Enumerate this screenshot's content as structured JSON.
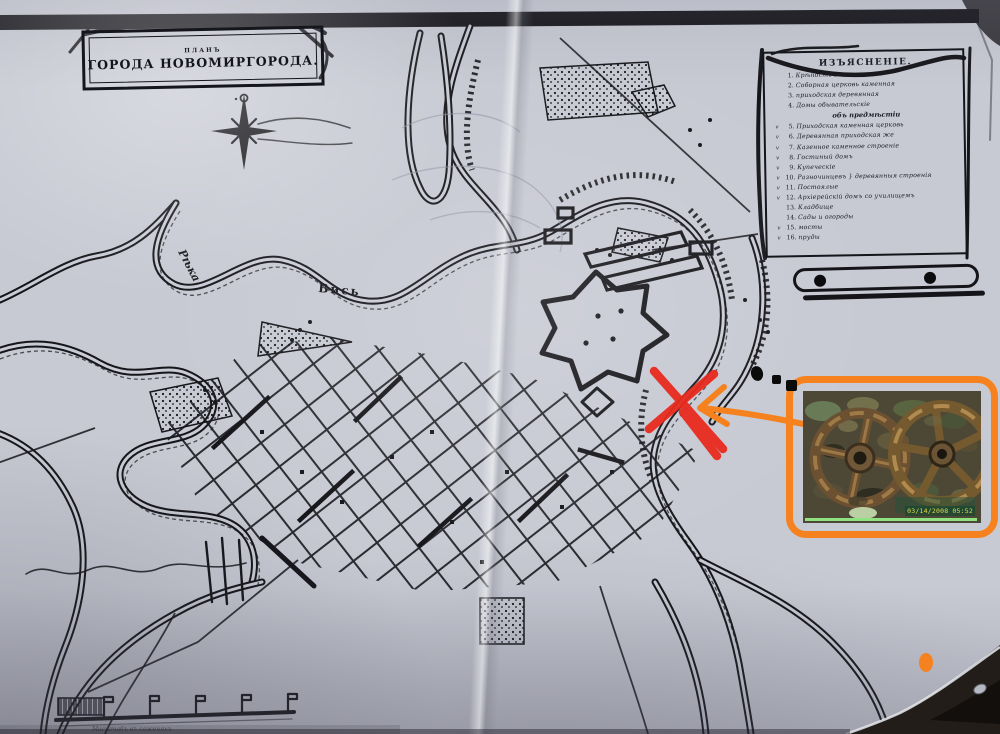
{
  "map": {
    "title": {
      "small": "ПЛАНЪ",
      "main": "ГОРОДА НОВОМИРГОРОДА."
    },
    "labels": {
      "river_word": "Рѣка",
      "river_name": "Вись"
    },
    "scale": {
      "caption": "Масштабъ въ саженяхъ"
    }
  },
  "legend": {
    "header": "ИЗЪЯСНЕНІЕ.",
    "subheader": "объ предмѣстіи",
    "items": [
      {
        "mark": "",
        "n": "1.",
        "text": "Крѣпость земляная"
      },
      {
        "mark": "",
        "n": "2.",
        "text": "Соборная церковь каменная"
      },
      {
        "mark": "",
        "n": "3.",
        "text": "приходская деревянная"
      },
      {
        "mark": "",
        "n": "4.",
        "text": "Домы обывательскіе"
      },
      {
        "mark": "v",
        "n": "5.",
        "text": "Приходская каменная церковь"
      },
      {
        "mark": "v",
        "n": "6.",
        "text": "Деревянная приходская же"
      },
      {
        "mark": "v",
        "n": "7.",
        "text": "Казенное каменное строеніе"
      },
      {
        "mark": "v",
        "n": "8.",
        "text": "Гостиный домъ"
      },
      {
        "mark": "v",
        "n": "9.",
        "text": "Купеческіе"
      },
      {
        "mark": "v",
        "n": "10.",
        "text": "Разночинцевъ } деревянныя строенія"
      },
      {
        "mark": "v",
        "n": "11.",
        "text": "Постоялые"
      },
      {
        "mark": "v",
        "n": "12.",
        "text": "Архіерейскій домъ со училищемъ"
      },
      {
        "mark": "",
        "n": "13.",
        "text": "Кладбище"
      },
      {
        "mark": "",
        "n": "14.",
        "text": "Сады и огороды"
      },
      {
        "mark": "v",
        "n": "15.",
        "text": "мосты"
      },
      {
        "mark": "v",
        "n": "16.",
        "text": "пруды"
      }
    ]
  },
  "photo": {
    "timestamp": "03/14/2008 05:52",
    "subject": "two-rusty-gear-wheels"
  },
  "icons": [
    "compass-rose-icon",
    "gear-left-icon",
    "gear-right-icon",
    "orange-arrow-icon",
    "red-x-mark"
  ],
  "colors": {
    "annotation_red": "#e92a1e",
    "annotation_orange": "#f5821f",
    "ink": "#15151a",
    "paper": "#c9cbd5",
    "timestamp_yellow": "#e8d84e",
    "photo_green_strip": "#8fe27f"
  }
}
